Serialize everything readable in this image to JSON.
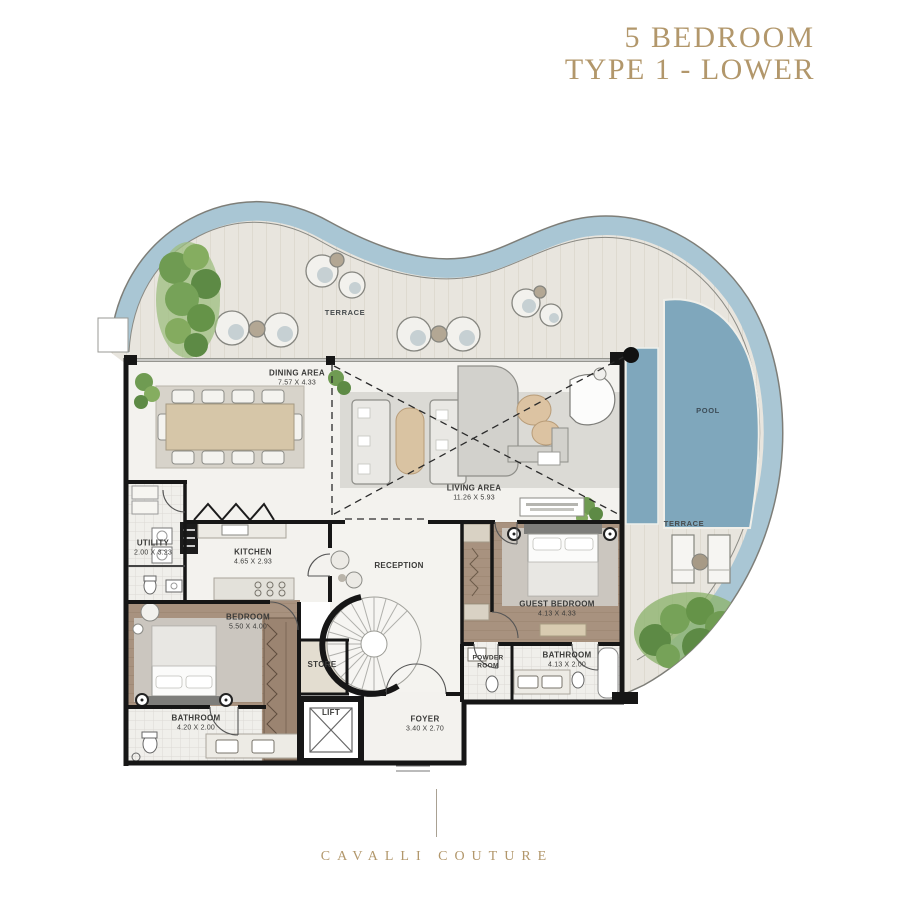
{
  "title": {
    "line1": "5 BEDROOM",
    "line2": "TYPE 1 - LOWER"
  },
  "brand": "CAVALLI COUTURE",
  "rooms": {
    "terrace_top": {
      "name": "TERRACE"
    },
    "terrace_right": {
      "name": "TERRACE"
    },
    "pool": {
      "name": "POOL"
    },
    "dining": {
      "name": "DINING AREA",
      "dims": "7.57 X 4.33"
    },
    "living": {
      "name": "LIVING AREA",
      "dims": "11.26 X 5.93"
    },
    "utility": {
      "name": "UTILITY",
      "dims": "2.00 X 3.23"
    },
    "kitchen": {
      "name": "KITCHEN",
      "dims": "4.65 X 2.93"
    },
    "reception": {
      "name": "RECEPTION"
    },
    "guest_bedroom": {
      "name": "GUEST BEDROOM",
      "dims": "4.13 X 4.33"
    },
    "bedroom": {
      "name": "BEDROOM",
      "dims": "5.50 X 4.00"
    },
    "bathroom_guest": {
      "name": "BATHROOM",
      "dims": "4.13 X 2.00"
    },
    "bathroom_master": {
      "name": "BATHROOM",
      "dims": "4.20 X 2.00"
    },
    "powder_room": {
      "line1": "POWDER",
      "line2": "ROOM"
    },
    "store": {
      "name": "STORE"
    },
    "lift": {
      "name": "LIFT"
    },
    "foyer": {
      "name": "FOYER",
      "dims": "3.40 X 2.70"
    }
  },
  "colors": {
    "gold": "#b2976b",
    "water_band": "#a9c6d4",
    "pool": "#7fa7bc",
    "walls": "#161616",
    "wood_floor": "#a8927f",
    "terrace_floor": "#e8e5de"
  }
}
